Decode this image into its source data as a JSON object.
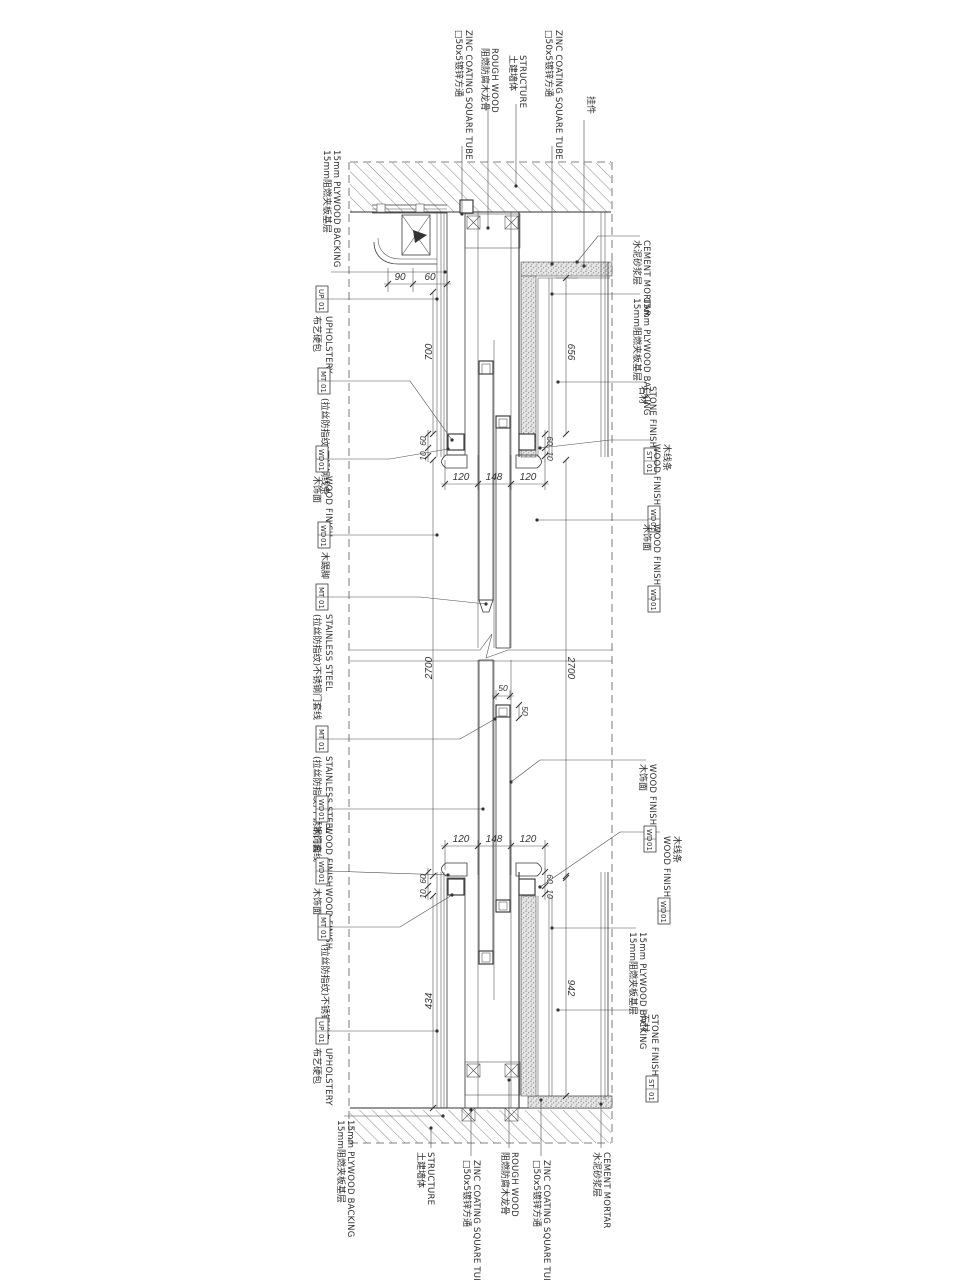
{
  "drawing": {
    "kind": "door-wall section detail (rotated CAD sheet)",
    "colors": {
      "paper": "#ffffff",
      "line": "#2e2e2e",
      "hatch": "#6a6a6a",
      "mortar": "#8a8a8a"
    }
  },
  "labels": {
    "plywood": {
      "en": "15mm PLYWOOD BACKING",
      "cn": "15mm阻燃夹板基层"
    },
    "upholstery": {
      "en": "UPHOLSTERY",
      "cn": "布艺硬包",
      "tag": {
        "code": "UP",
        "num": "01"
      }
    },
    "ss_strip": {
      "cn": "(拉丝防指纹)不锈钢线条",
      "tag": {
        "code": "MT",
        "num": "01"
      }
    },
    "wood_finish": {
      "en": "WOOD FINISH",
      "cn": "木饰面",
      "tag": {
        "code": "WD",
        "num": "01"
      }
    },
    "skirting": {
      "cn": "木踢脚",
      "tag": {
        "code": "WD",
        "num": "01"
      }
    },
    "ss_frame": {
      "en": "STAINLESS STEEL",
      "cn": "(拉丝防指纹)不锈钢门套线",
      "tag": {
        "code": "MT",
        "num": "01"
      }
    },
    "wood_molding": {
      "en": "WOOD FINISH",
      "cn": "木线条",
      "tag": {
        "code": "WD",
        "num": "01"
      }
    },
    "stone": {
      "en": "STONE FINISH",
      "cn": "石材",
      "tag": {
        "code": "ST",
        "num": "01"
      }
    },
    "cement": {
      "en": "CEMENT MORTAR",
      "cn": "水泥砂浆层"
    },
    "zinc": {
      "en": "ZINC COATING SQUARE TUBE",
      "cn": "□50x5镀锌方通"
    },
    "rough": {
      "en": "ROUGH WOOD",
      "cn": "阻燃防腐木龙骨"
    },
    "structure": {
      "en": "STRUCTURE",
      "cn": "土建墙体"
    },
    "hanger": {
      "cn": "挂件"
    }
  },
  "dims": {
    "d90": "90",
    "d60": "60",
    "d10": "10",
    "d700": "700",
    "d656": "656",
    "d120": "120",
    "d148": "148",
    "d2700": "2700",
    "d50": "50",
    "d434": "434",
    "d942": "942"
  }
}
